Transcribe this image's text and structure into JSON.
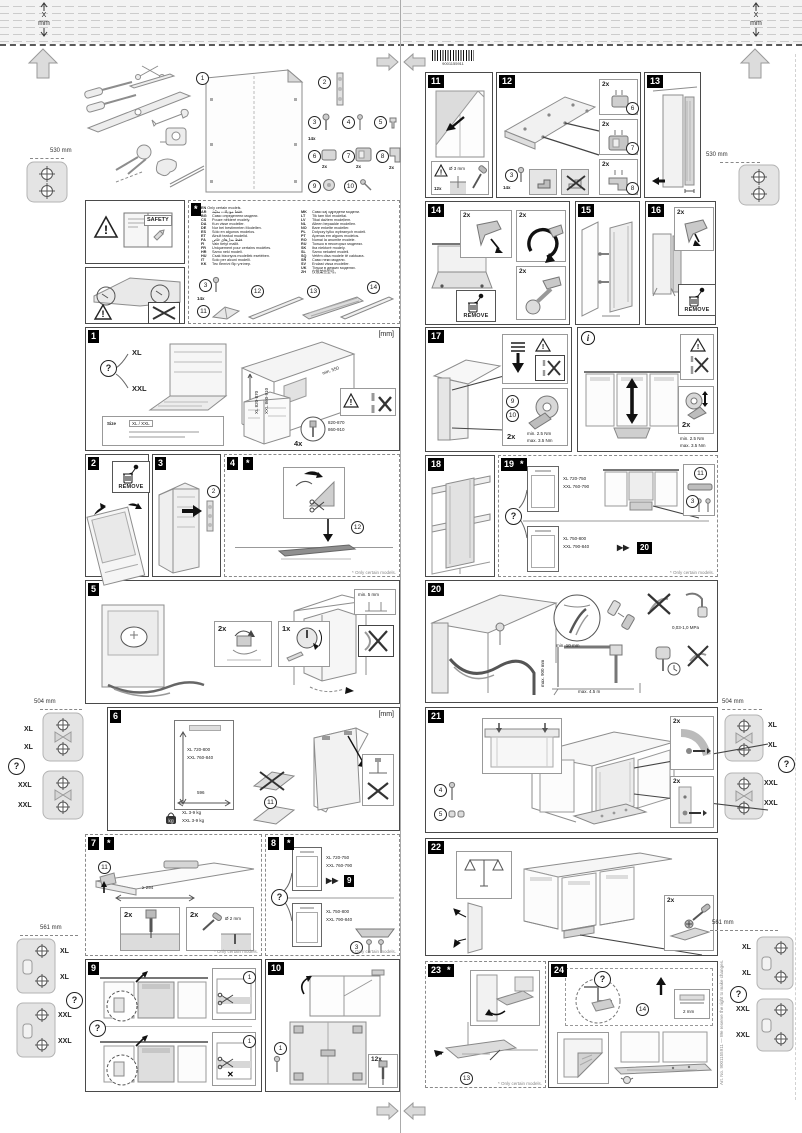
{
  "doc": {
    "fold_x": "X",
    "fold_unit": "mm",
    "barcode_number": "9001155911",
    "side_note": "Art. No. 9001155911 — We reserve the right to make changes."
  },
  "common": {
    "remove": "REMOVE",
    "mm": "[mm]",
    "q": "?",
    "xl": "XL",
    "xxl": "XXL",
    "star": "*",
    "info": "i",
    "only": "* Only certain models.",
    "skip": "▶▶"
  },
  "margins": {
    "d530": "530 mm",
    "d504": "504 mm",
    "d561": "561 mm"
  },
  "safety": {
    "label": "SAFETY"
  },
  "languages": {
    "header": {
      "code": "EN",
      "text": "Only certain models."
    },
    "left": [
      {
        "code": "AR",
        "text": "فقط موديلات معيّنة."
      },
      {
        "code": "BG",
        "text": "Само определени модели."
      },
      {
        "code": "CS",
        "text": "Pouze některé modely."
      },
      {
        "code": "DA",
        "text": "Kun visse modeller."
      },
      {
        "code": "DE",
        "text": "Nur bei bestimmten Modellen."
      },
      {
        "code": "ES",
        "text": "Sólo en algunos modelos."
      },
      {
        "code": "ET",
        "text": "Ainult teatud mudelid."
      },
      {
        "code": "FA",
        "text": "فقط مدل‌های خاص."
      },
      {
        "code": "FI",
        "text": "Vain tietyt mallit."
      },
      {
        "code": "FR",
        "text": "Uniquement pour certains modèles."
      },
      {
        "code": "HR",
        "text": "Samo neki modeli."
      },
      {
        "code": "HU",
        "text": "Csak bizonyos modellek esetében."
      },
      {
        "code": "IT",
        "text": "Solo per alcuni modelli."
      },
      {
        "code": "KK",
        "text": "Тек белгілі бір үлгілер."
      }
    ],
    "right": [
      {
        "code": "MK",
        "text": "Само кај одредени модели."
      },
      {
        "code": "LT",
        "text": "Tik tam tikri modeliai."
      },
      {
        "code": "LV",
        "text": "Tikai dažiem modeļiem."
      },
      {
        "code": "NL",
        "text": "Alleen bepaalde modellen."
      },
      {
        "code": "NO",
        "text": "Bare enkelte modeller."
      },
      {
        "code": "PL",
        "text": "Dotyczy tylko wybranych modeli."
      },
      {
        "code": "PT",
        "text": "Apenas em alguns modelos."
      },
      {
        "code": "RO",
        "text": "Numai la anumite modele."
      },
      {
        "code": "RU",
        "text": "Только в некоторых моделях."
      },
      {
        "code": "SK",
        "text": "Iba niektoré modely."
      },
      {
        "code": "SL",
        "text": "Samo nekateri modeli."
      },
      {
        "code": "SQ",
        "text": "Vetëm disa modele të caktuara."
      },
      {
        "code": "SR",
        "text": "Само неки модели."
      },
      {
        "code": "SV",
        "text": "Endast vissa modeller."
      },
      {
        "code": "UK",
        "text": "Тільки в деяких моделях."
      },
      {
        "code": "ZH",
        "text": "仅限某些型号。"
      }
    ],
    "strip": {
      "screw": "3",
      "screw_qty": "14x",
      "sheet": "11",
      "strip": "12",
      "rail_a": "13",
      "rail_b": "14"
    }
  },
  "parts": {
    "p1": "1",
    "p2": "2",
    "p3": "3",
    "p3_qty": "14x",
    "p4": "4",
    "p5": "5",
    "p6": "6",
    "p6_qty": "2x",
    "p7": "7",
    "p7_qty": "2x",
    "p8": "8",
    "p8_qty": "2x",
    "p9": "9",
    "p10": "10"
  },
  "p1": {
    "num": "1",
    "dim_xl": "XL 820-870",
    "dim_xxl": "XXL 860-910",
    "min_depth": "min. 550",
    "size_label": "Size",
    "size_value": "XL / XXL",
    "qty": "4x",
    "dim_a": "820-870",
    "dim_b": "860-910"
  },
  "p2": {
    "num": "2"
  },
  "p3": {
    "num": "3",
    "part": "2"
  },
  "p4": {
    "num": "4",
    "part": "12"
  },
  "p5": {
    "num": "5",
    "qty_a": "2x",
    "qty_b": "1x",
    "min_gap": "min. 5 mm"
  },
  "p6": {
    "num": "6",
    "dim_xl": "XL 720-800",
    "dim_xxl": "XXL 760-840",
    "width": "596",
    "max_lbl": "max",
    "w_xl": "XL 3-9 kg",
    "w_xxl": "XXL 3-9 kg",
    "part": "11"
  },
  "p7": {
    "num": "7",
    "part": "11",
    "dim": "≥ 294",
    "qty": "2x",
    "drill": "Ø 2 mm"
  },
  "p8": {
    "num": "8",
    "top_xl": "XL 720-750",
    "top_xxl": "XXL 760-790",
    "skip": "9",
    "bot_xl": "XL 750-800",
    "bot_xxl": "XXL 790-840",
    "part": "3"
  },
  "p9": {
    "num": "9",
    "part": "1"
  },
  "p10": {
    "num": "10",
    "part": "1",
    "qty": "12x"
  },
  "p11": {
    "num": "11",
    "drill": "Ø 3 mm",
    "qty": "12x"
  },
  "p12": {
    "num": "12",
    "qty": "2x",
    "part_a": "6",
    "part_b": "7",
    "part_c": "8",
    "screw": "3",
    "screw_qty": "14x"
  },
  "p13": {
    "num": "13"
  },
  "p14": {
    "num": "14",
    "qty": "2x"
  },
  "p15": {
    "num": "15"
  },
  "p16": {
    "num": "16",
    "qty": "2x"
  },
  "p17": {
    "num": "17",
    "part_a": "9",
    "part_b": "10",
    "qty": "2x",
    "tq_min": "min. 2.5 Nm",
    "tq_max": "max. 3.5 Nm"
  },
  "pinfo": {
    "badge": "i",
    "qty": "2x",
    "tq_min": "min. 2.5 Nm",
    "tq_max": "max. 3.5 Nm"
  },
  "p18": {
    "num": "18"
  },
  "p19": {
    "num": "19",
    "top_xl": "XL 720-750",
    "top_xxl": "XXL 760-790",
    "part_a": "11",
    "part_b": "3",
    "bot_xl": "XL 750-800",
    "bot_xxl": "XXL 790-840",
    "skip": "20"
  },
  "p20": {
    "num": "20",
    "hole": "min. 10 mm",
    "pressure": "0,03-1,0 MPa",
    "v_dim": "max. 900 mm",
    "h_dim": "max. 4.5 m"
  },
  "p21": {
    "num": "21",
    "part_a": "4",
    "part_b": "5",
    "qty": "2x"
  },
  "p22": {
    "num": "22",
    "qty": "2x"
  },
  "p23": {
    "num": "23",
    "part": "13"
  },
  "p24": {
    "num": "24",
    "part": "14",
    "gap": "2 mm"
  }
}
